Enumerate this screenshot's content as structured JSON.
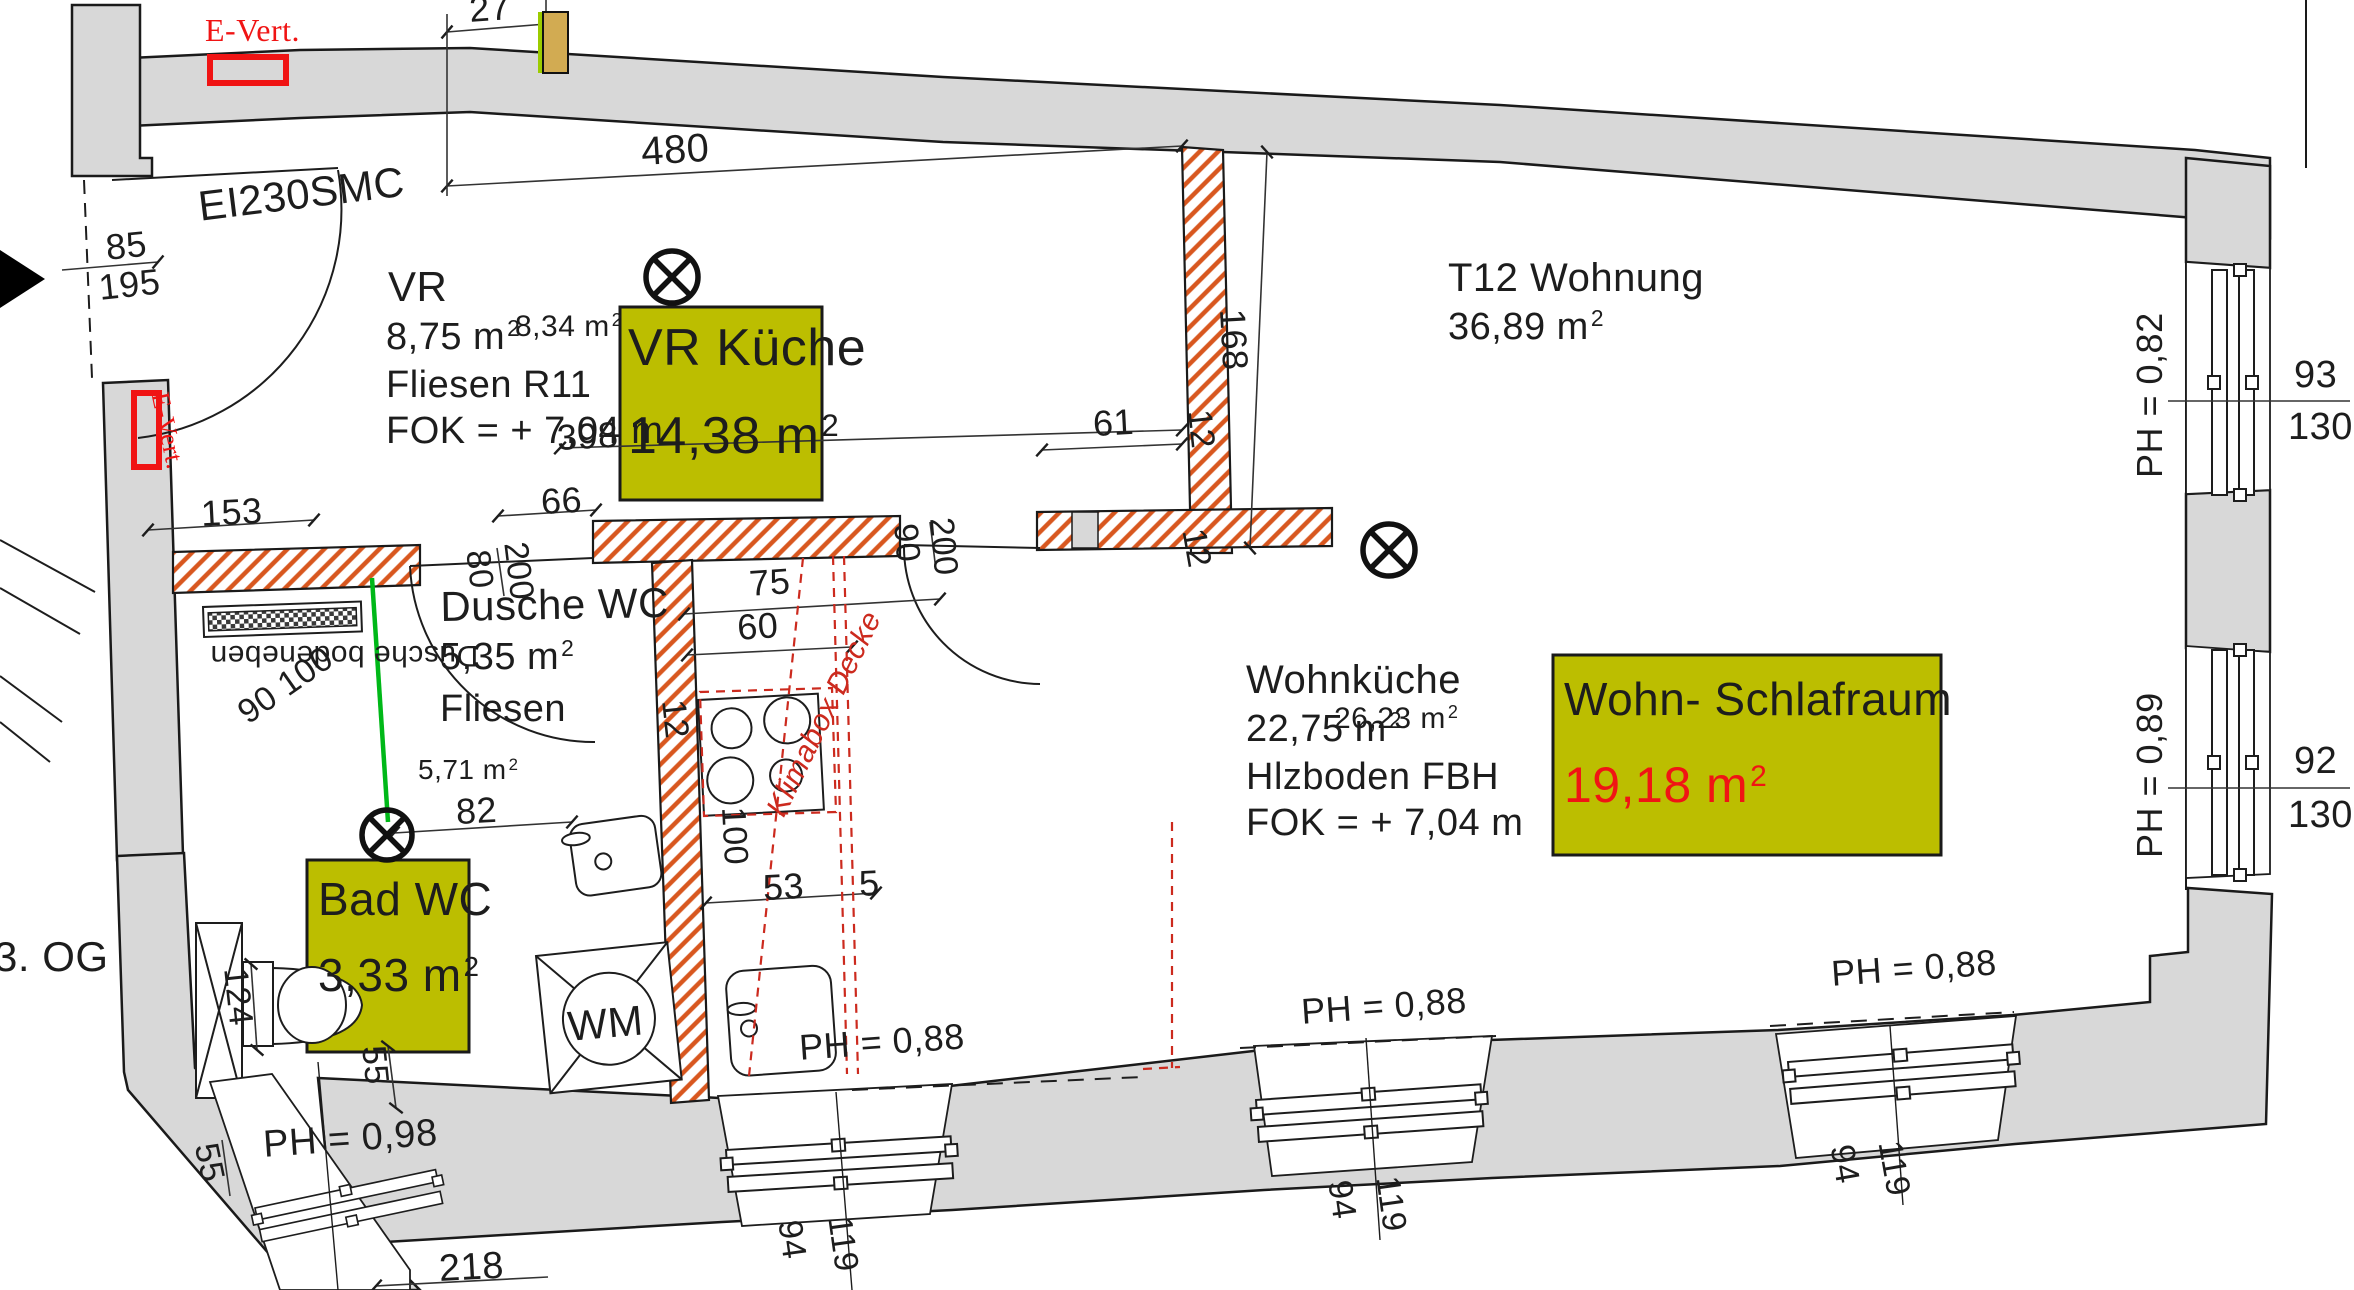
{
  "colors": {
    "wall_grey": "#d8d8d8",
    "hatch_red": "#d8571f",
    "highlight_yellow": "#bcbe00",
    "accent_red": "#f01414",
    "marker_red": "#cc2a1e",
    "green": "#00b818",
    "tan": "#d2ab52",
    "lime": "#9ccc00",
    "line": "#1d1d1d"
  },
  "floor_label": "3. OG",
  "unit": {
    "name": "T12 Wohnung",
    "area": {
      "v": "36,89 m",
      "s": "2"
    }
  },
  "rooms": {
    "vr": {
      "name": "VR",
      "area": {
        "v": "8,75 m",
        "s": "2"
      },
      "area_alt": {
        "v": "8,34 m",
        "s": "2"
      },
      "floor": "Fliesen R11",
      "level": "FOK = + 7,04 m"
    },
    "dusche_wc": {
      "name": "Dusche WC",
      "area": {
        "v": "5,35 m",
        "s": "2"
      },
      "floor": "Fliesen"
    },
    "wohnkueche": {
      "name": "Wohnküche",
      "area": {
        "v": "22,75 m",
        "s": "2"
      },
      "area_alt": {
        "v": "26,23 m",
        "s": "2"
      },
      "floor": "Hlzboden FBH",
      "level": "FOK = + 7,04 m"
    },
    "bad_sub_area": {
      "v": "5,71 m",
      "s": "2"
    }
  },
  "highlights": {
    "vr_kueche": {
      "label": "VR Küche",
      "area": {
        "v": "14,38 m",
        "s": "2"
      }
    },
    "wohn_schlafraum": {
      "label": "Wohn- Schlafraum",
      "area": {
        "v": "19,18 m",
        "s": "2"
      }
    },
    "bad_wc": {
      "label": "Bad WC",
      "area": {
        "v": "3,33 m",
        "s": "2"
      }
    }
  },
  "annotations": {
    "e_vert_top": "E-Vert.",
    "e_vert_left": "E-Vert.",
    "door_spec": "EI230SMC",
    "shower_note": "Dusche bodeneben",
    "shower_size": "90 100",
    "klimabox": "Klimabox Decke",
    "washer": "WM"
  },
  "parapets": {
    "right_top": "PH = 0,82",
    "right_bottom": "PH = 0,89",
    "bottom_left": "PH = 0,98",
    "bottom_1": "PH = 0,88",
    "bottom_2": "PH = 0,88",
    "bottom_3": "PH = 0,88"
  },
  "dimensions": {
    "d480": "480",
    "d27": "27",
    "d85": "85",
    "d195": "195",
    "d398": "398",
    "d153": "153",
    "d66": "66",
    "d80": "80",
    "d200a": "200",
    "d90": "90",
    "d200b": "200",
    "d61": "61",
    "d168": "168",
    "d12a": "12",
    "d12b": "12",
    "d12c": "12",
    "d75": "75",
    "d60": "60",
    "d100": "100",
    "d53": "53",
    "d5": "5",
    "d82": "82",
    "d55a": "55",
    "d55b": "55",
    "d124": "124",
    "d218": "218",
    "win_bottom_1": {
      "n": "94",
      "d": "119"
    },
    "win_bottom_2": {
      "n": "94",
      "d": "119"
    },
    "win_bottom_3": {
      "n": "94",
      "d": "119"
    },
    "win_right_top": {
      "n": "93",
      "d": "130"
    },
    "win_right_bottom": {
      "n": "92",
      "d": "130"
    }
  }
}
